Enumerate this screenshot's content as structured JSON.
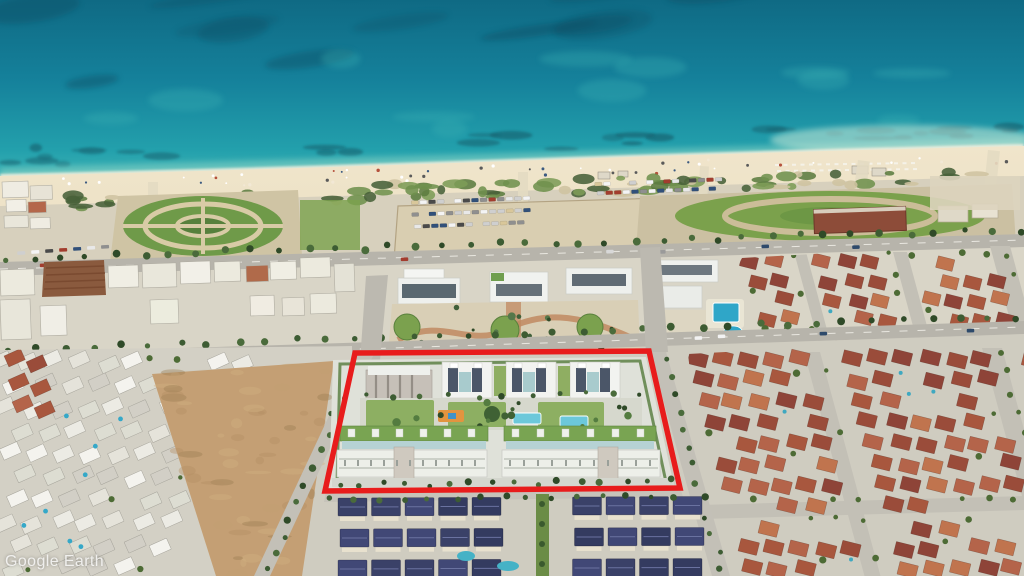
{
  "watermark": {
    "text": "Google Earth"
  },
  "annotation": {
    "label": "site-boundary-highlight",
    "shape": "quadrilateral",
    "points": "355,353 649,351 680,488 325,491",
    "color": "#e81c1c",
    "stroke_width": "5.5"
  },
  "palette": {
    "highlight_red": "#e81c1c",
    "watermark_white": "#ffffff",
    "sea_deep": "#11708a",
    "sea_light": "#49bcba",
    "beach_sand": "#ecdfc2",
    "terracotta_roof": "#a8573e",
    "new_build_white": "#f2f3f0"
  }
}
